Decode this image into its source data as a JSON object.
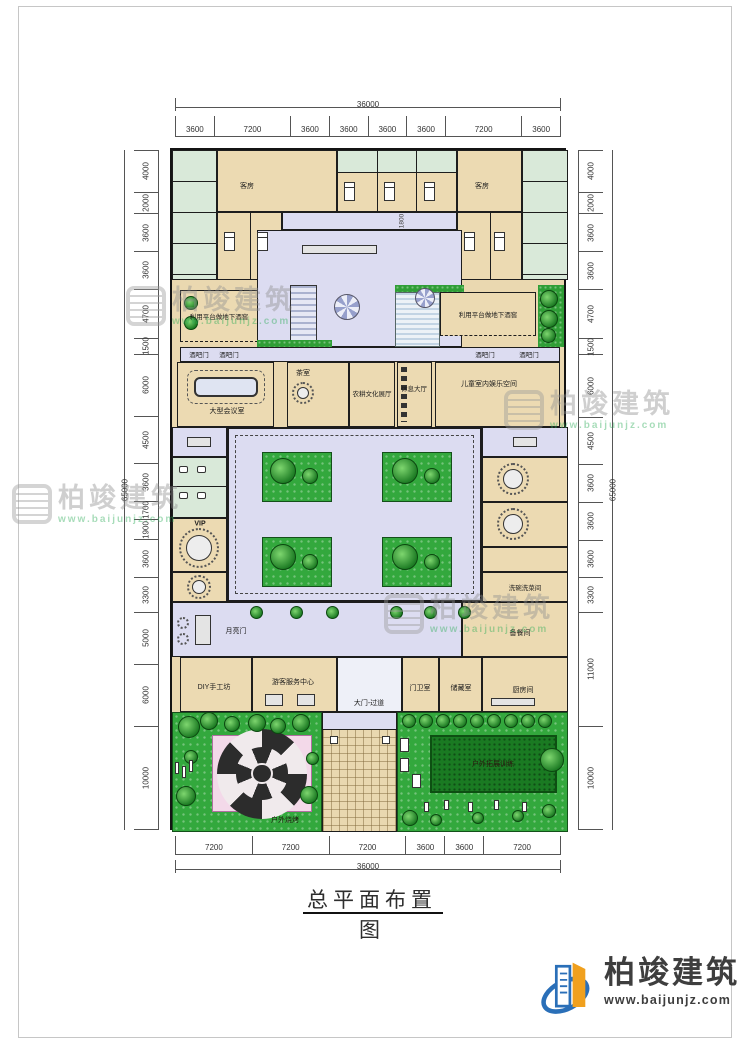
{
  "title": {
    "text": "总平面布置图"
  },
  "logo": {
    "name": "柏竣建筑",
    "url": "www.baijunjz.com"
  },
  "watermark": {
    "name": "柏竣建筑",
    "url": "www.baijunjz.com"
  },
  "dimensions": {
    "top": {
      "total": "36000",
      "segments": [
        "3600",
        "7200",
        "3600",
        "3600",
        "3600",
        "3600",
        "7200",
        "3600"
      ]
    },
    "bottom": {
      "total": "36000",
      "segments": [
        "7200",
        "7200",
        "7200",
        "3600",
        "3600",
        "7200"
      ]
    },
    "left": {
      "total": "65000",
      "segments": [
        "4000",
        "2000",
        "3600",
        "3600",
        "4700",
        "1500",
        "6000",
        "4500",
        "3600",
        "1700",
        "1900",
        "3600",
        "3300",
        "5000",
        "6000",
        "10000"
      ]
    },
    "right": {
      "total": "65000",
      "segments": [
        "4000",
        "2000",
        "3600",
        "3600",
        "4700",
        "1500",
        "6000",
        "4500",
        "3600",
        "3600",
        "3600",
        "3300",
        "11000",
        "10000"
      ]
    },
    "inner_corridor": "1800"
  },
  "rooms": {
    "guest": "客房",
    "cellar": "利用平台做地下酒窖",
    "bar_door": "酒吧门",
    "conference": "大型会议室",
    "tea": "茶室",
    "exhibit": "农耕文化展厅",
    "rest_hall": "休息大厅",
    "kids": "儿童室内娱乐空间",
    "vip": "VIP",
    "moon_gate": "月亮门",
    "diy": "DIY手工坊",
    "visitor_center": "游客服务中心",
    "gate": "大门-过道",
    "guard": "门卫室",
    "storage": "储藏室",
    "kitchen": "厨房间",
    "prep": "备餐间",
    "wash": "洗碗洗菜间",
    "bbq": "户外烧烤",
    "training": "户外拓展训练"
  }
}
